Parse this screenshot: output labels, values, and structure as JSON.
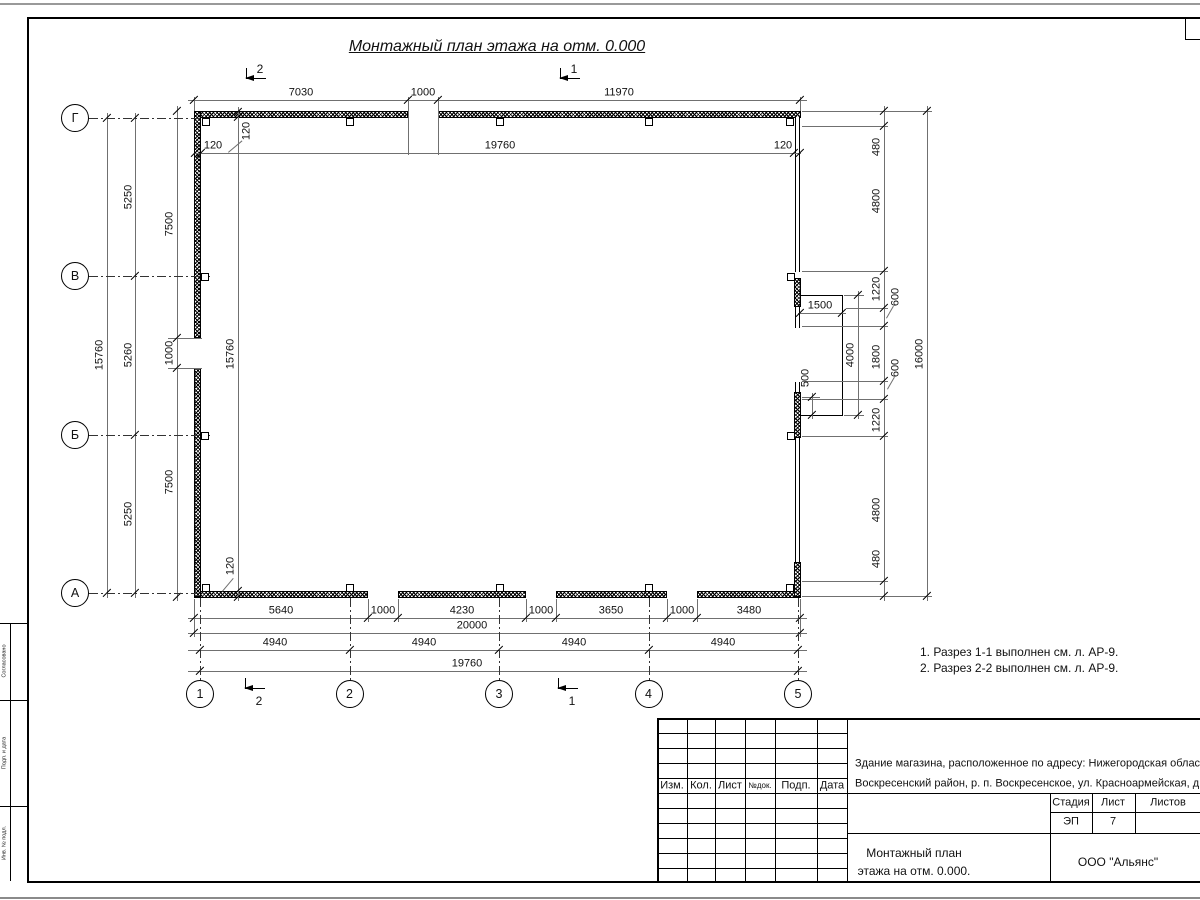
{
  "title": "Монтажный план этажа на отм. 0.000",
  "axes": {
    "left": [
      "Г",
      "В",
      "Б",
      "А"
    ],
    "bottom": [
      "1",
      "2",
      "3",
      "4",
      "5"
    ]
  },
  "sections": {
    "top": [
      "2",
      "1"
    ],
    "bottom": [
      "2",
      "1"
    ]
  },
  "dims": {
    "top": [
      "7030",
      "1000",
      "11970"
    ],
    "inner_top": [
      "120",
      "19760",
      "120"
    ],
    "left": {
      "outer": "15760",
      "axis": [
        "5250",
        "5260",
        "5250"
      ],
      "wall": [
        "7500",
        "1000",
        "7500"
      ],
      "inner": "15760",
      "thickness_top": "120",
      "thickness_bottom": "120"
    },
    "right": {
      "chain": [
        "480",
        "4800",
        "1220",
        "600",
        "1800",
        "600",
        "1220",
        "4800",
        "480"
      ],
      "total": "16000",
      "porch_width": "1500",
      "porch_depth": "4000",
      "porch_offset": "500"
    },
    "bottom": {
      "openings": [
        "5640",
        "1000",
        "4230",
        "1000",
        "3650",
        "1000",
        "3480"
      ],
      "total": "20000",
      "axis": [
        "4940",
        "4940",
        "4940",
        "4940"
      ],
      "axis_total": "19760"
    }
  },
  "notes": [
    "1. Разрез 1-1 выполнен см. л. АР-9.",
    "2. Разрез 2-2 выполнен см. л. АР-9."
  ],
  "tb": {
    "cols": [
      "Изм.",
      "Кол.",
      "Лист",
      "№док.",
      "Подп.",
      "Дата"
    ],
    "desc1": "Здание магазина, расположенное по адресу: Нижегородская область,",
    "desc2": "Воскресенский район, р. п. Воскресенское, ул. Красноармейская, д. 1",
    "stage_label": "Стадия",
    "sheet_label": "Лист",
    "sheets_label": "Листов",
    "stage_value": "ЭП",
    "sheet_value": "7",
    "name1": "Монтажный план",
    "name2": "этажа на отм. 0.000.",
    "company": "ООО \"Альянс\""
  },
  "frame_labels": [
    "Согласовано",
    "Подп. и дата",
    "Инв. № подл."
  ]
}
